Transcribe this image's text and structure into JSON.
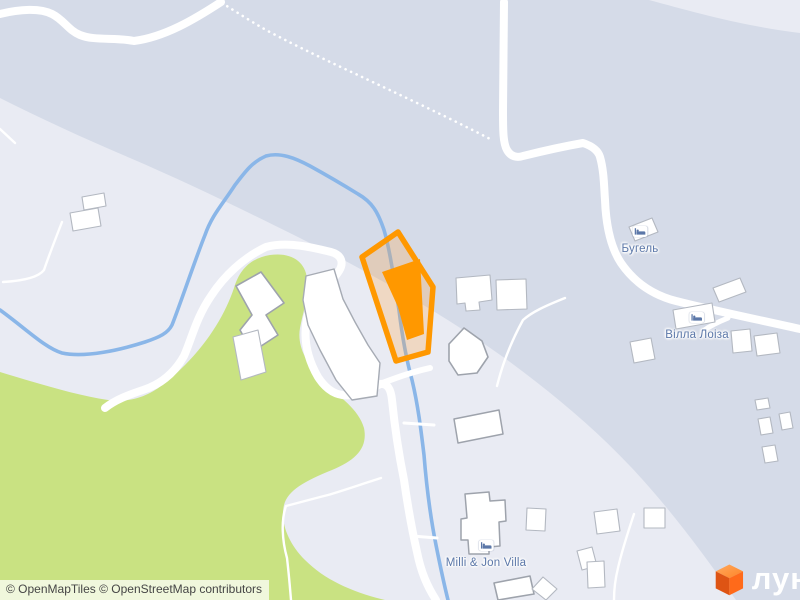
{
  "map": {
    "provider_note": "residential map tile view",
    "pois": {
      "bugel": {
        "name": "Бугель",
        "type": "hotel"
      },
      "villa_loiza": {
        "name": "Вілла Лоіза",
        "type": "hotel"
      },
      "milli_jon": {
        "name": "Milli & Jon Villa",
        "type": "hotel"
      }
    },
    "selection": {
      "kind": "highlighted-parcel-with-building",
      "color": "#FF9800"
    },
    "colors": {
      "background_light": "#E9EBF3",
      "background_shade": "#D5DBE8",
      "park_green": "#C9E282",
      "water_blue": "#8AB6E8",
      "road_white": "#FFFFFF",
      "building_shadow": "#AEB3BC",
      "label_blue": "#5B77A8",
      "selection_orange": "#FF9800",
      "logo_orange": "#FF6A1A"
    }
  },
  "attribution": {
    "text": "© OpenMapTiles © OpenStreetMap contributors"
  },
  "brand": {
    "logo_text": "лун"
  }
}
